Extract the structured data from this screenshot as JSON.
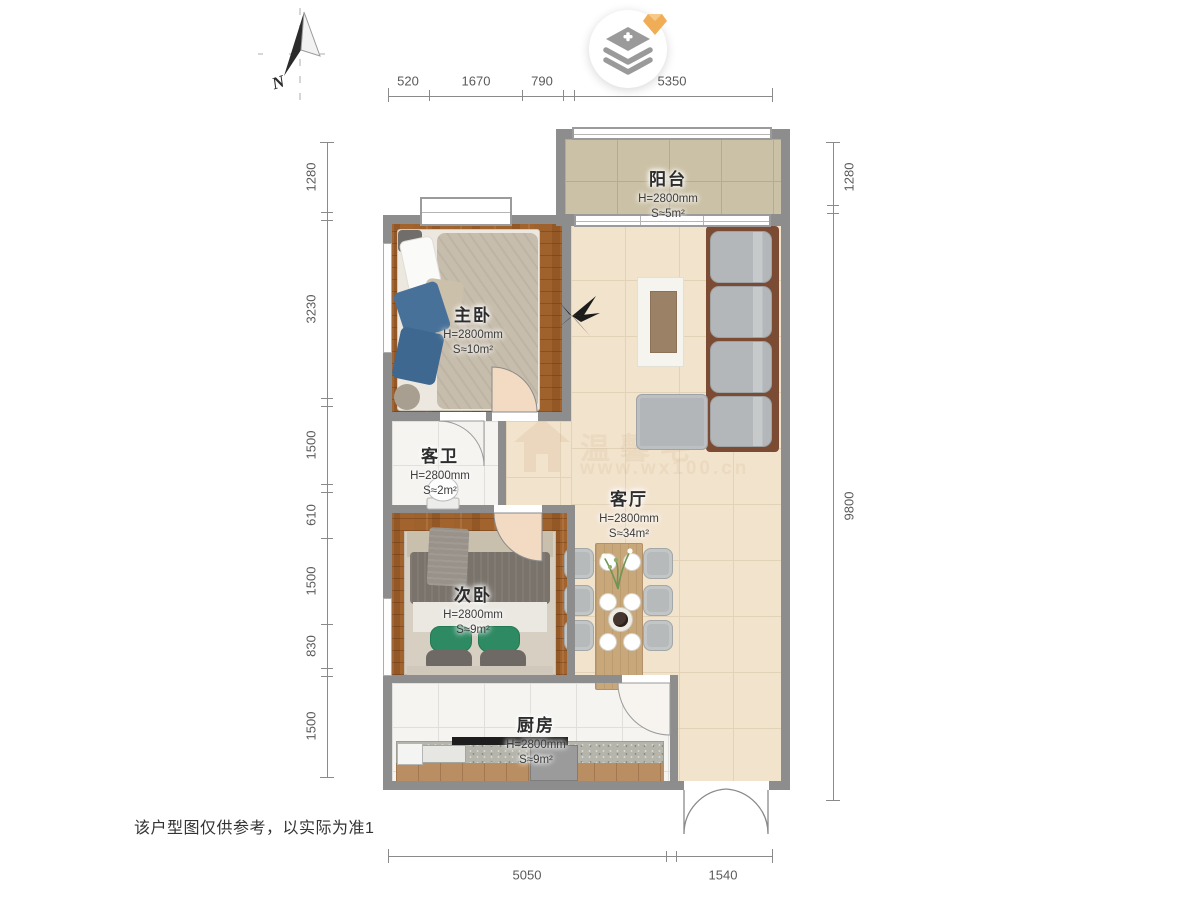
{
  "page": {
    "disclaimer": "该户型图仅供参考，以实际为准1"
  },
  "compass": {
    "north_label": "N"
  },
  "toolbar": {
    "layers_button_icon": "add-layers-icon",
    "badge_icon": "gem-diamond-badge"
  },
  "watermark": {
    "line1": "温馨宅",
    "line2": "www.wx100.cn"
  },
  "rooms": [
    {
      "id": "balcony",
      "name": "阳台",
      "height": "H=2800mm",
      "area": "S≈5m²"
    },
    {
      "id": "master-bedroom",
      "name": "主卧",
      "height": "H=2800mm",
      "area": "S≈10m²"
    },
    {
      "id": "bathroom",
      "name": "客卫",
      "height": "H=2800mm",
      "area": "S≈2m²"
    },
    {
      "id": "second-bedroom",
      "name": "次卧",
      "height": "H=2800mm",
      "area": "S≈9m²"
    },
    {
      "id": "living-room",
      "name": "客厅",
      "height": "H=2800mm",
      "area": "S≈34m²"
    },
    {
      "id": "kitchen",
      "name": "厨房",
      "height": "H=2800mm",
      "area": "S≈9m²"
    }
  ],
  "dimensions": {
    "top": [
      "520",
      "1670",
      "790",
      "5350"
    ],
    "left": [
      "1280",
      "3230",
      "1500",
      "610",
      "1500",
      "830",
      "1500"
    ],
    "right": [
      "1280",
      "9800"
    ],
    "bottom": [
      "5050",
      "1540"
    ]
  },
  "colors": {
    "wall": "#8d8d8d",
    "wood_floor": "#a0622d",
    "living_tile": "#f2e3cd",
    "balcony_tile": "#cbc1a6",
    "badge_accent": "#f0ad55"
  }
}
